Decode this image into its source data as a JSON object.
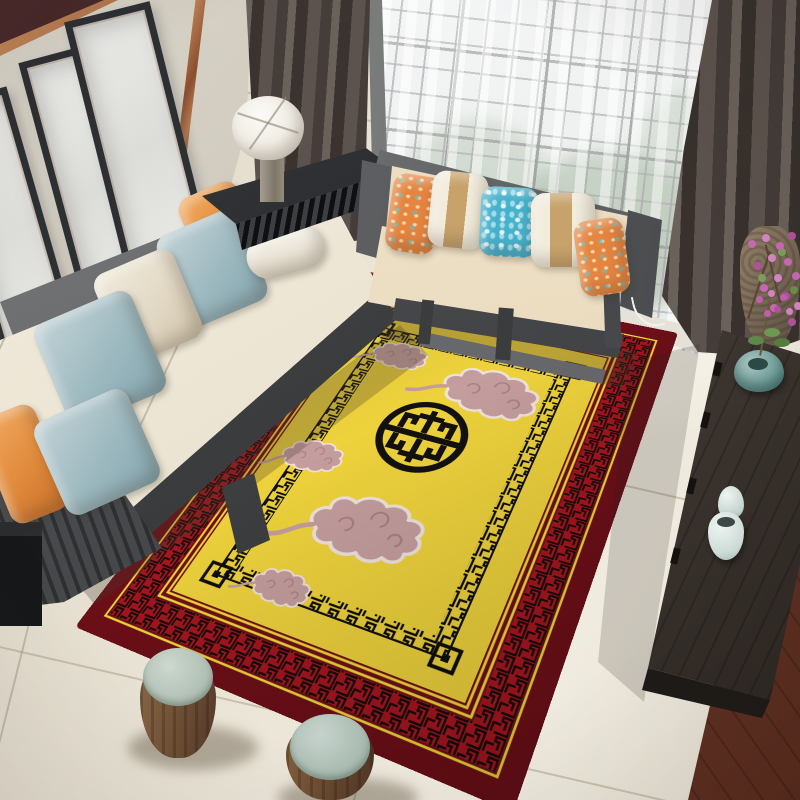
{
  "meta": {
    "type": "natural-image",
    "description": "3D rendered living-room product scene: a yellow Chinese-style area rug with black shou medallion, pink cloud motifs, black fretwork inner border and red meander outer border, surrounded by a gray-framed cream sofa with blue and orange pillows, a beige two-seat sofa with striped and floral pillows, a drum lamp on a black console, sheer lattice windows with dark taupe curtains, a long dark sideboard with celadon vases and pink blossoms, two barrel stools with sage tops, on a light tile floor"
  },
  "palette": {
    "rug_yellow": "#e8cf3e",
    "rug_red_band": "#a7151f",
    "rug_maroon": "#6e0f18",
    "rug_line_yellow": "#f4d73b",
    "rug_pattern_black": "#131110",
    "cloud_pink": "#c49d9e",
    "cloud_outline": "#efe2dc",
    "floor_tile": "#e9e3d5",
    "floor_grout": "#b7ab96",
    "wood_floor_corner": "#6f3a28",
    "wall": "#cbc4b6",
    "beam_maroon": "#402528",
    "copper_trim": "#a96b42",
    "frame_dark": "#2d3033",
    "window_mullion": "#6f7270",
    "foliage_green": "#6f8f68",
    "curtain_dark": "#554c47",
    "sofa_frame_gray": "#55575a",
    "sofa_cream": "#efe8d8",
    "sofa_beige": "#ead9bd",
    "pillow_blue": "#9db9c0",
    "pillow_orange": "#e08a3c",
    "pillow_teal": "#45b2cc",
    "pillow_stripe_tan": "#c7a26b",
    "lamp_shade": "#f3f1ea",
    "console_black": "#26272a",
    "sideboard_gray": "#453d37",
    "stool_wood": "#7a5a3e",
    "stool_top_sage": "#b7c4ba",
    "celadon": "#d6e2de",
    "lotus_vase_teal": "#6f9e9a",
    "blossom_pink": "#c969b5"
  },
  "objects": [
    {
      "name": "area-rug",
      "style": "chinese imperial",
      "motifs": [
        "shou-medallion",
        "auspicious-clouds",
        "greek-key-border",
        "meander-red-band"
      ]
    },
    {
      "name": "left-sofa",
      "pillows": [
        "orange",
        "blue",
        "white-bolster",
        "cream",
        "blue",
        "blue",
        "orange"
      ]
    },
    {
      "name": "center-sofa",
      "pillows": [
        "orange-floral",
        "white-tan-stripe",
        "teal-floral",
        "white-tan-stripe",
        "orange-floral"
      ]
    },
    {
      "name": "picture-frames",
      "count": 3
    },
    {
      "name": "table-lamp",
      "parts": [
        "white-drum-shade",
        "marble-base"
      ]
    },
    {
      "name": "console-table"
    },
    {
      "name": "sheer-lattice-window"
    },
    {
      "name": "dark-curtains",
      "count": 2
    },
    {
      "name": "sideboard",
      "items": [
        "lotus-vase-with-orchid",
        "celadon-jar-pair"
      ]
    },
    {
      "name": "floor-vase-with-pink-blossoms"
    },
    {
      "name": "barrel-stools",
      "count": 2
    },
    {
      "name": "tile-floor"
    },
    {
      "name": "wood-plank-corner"
    }
  ]
}
